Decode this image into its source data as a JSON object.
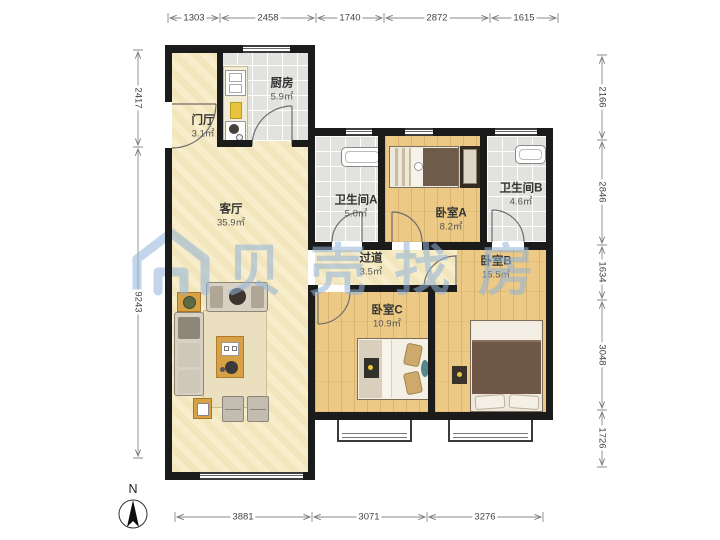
{
  "watermark": {
    "text": "贝壳找房",
    "color": "#8fb3d9"
  },
  "compass": {
    "label": "N"
  },
  "rooms": [
    {
      "name": "门厅",
      "area": "3.1㎡"
    },
    {
      "name": "厨房",
      "area": "5.9㎡"
    },
    {
      "name": "客厅",
      "area": "35.9㎡"
    },
    {
      "name": "卫生间A",
      "area": "5.0㎡"
    },
    {
      "name": "卧室A",
      "area": "8.2㎡"
    },
    {
      "name": "卫生间B",
      "area": "4.6㎡"
    },
    {
      "name": "过道",
      "area": "3.5㎡"
    },
    {
      "name": "卧室B",
      "area": "15.5㎡"
    },
    {
      "name": "卧室C",
      "area": "10.9㎡"
    }
  ],
  "dimensions": {
    "top": [
      "1303",
      "2458",
      "1740",
      "2872",
      "1615"
    ],
    "left": [
      "2417",
      "9243"
    ],
    "right": [
      "2166",
      "2846",
      "1634",
      "3048",
      "1726"
    ],
    "bottom": [
      "3881",
      "3071",
      "3276"
    ]
  },
  "colors": {
    "wall": "#1b1b1b",
    "wood_floor": "#ecc985",
    "tile_floor": "#e2e2de",
    "living_floor": "#f7edca",
    "watermark": "#8fb3d9"
  }
}
